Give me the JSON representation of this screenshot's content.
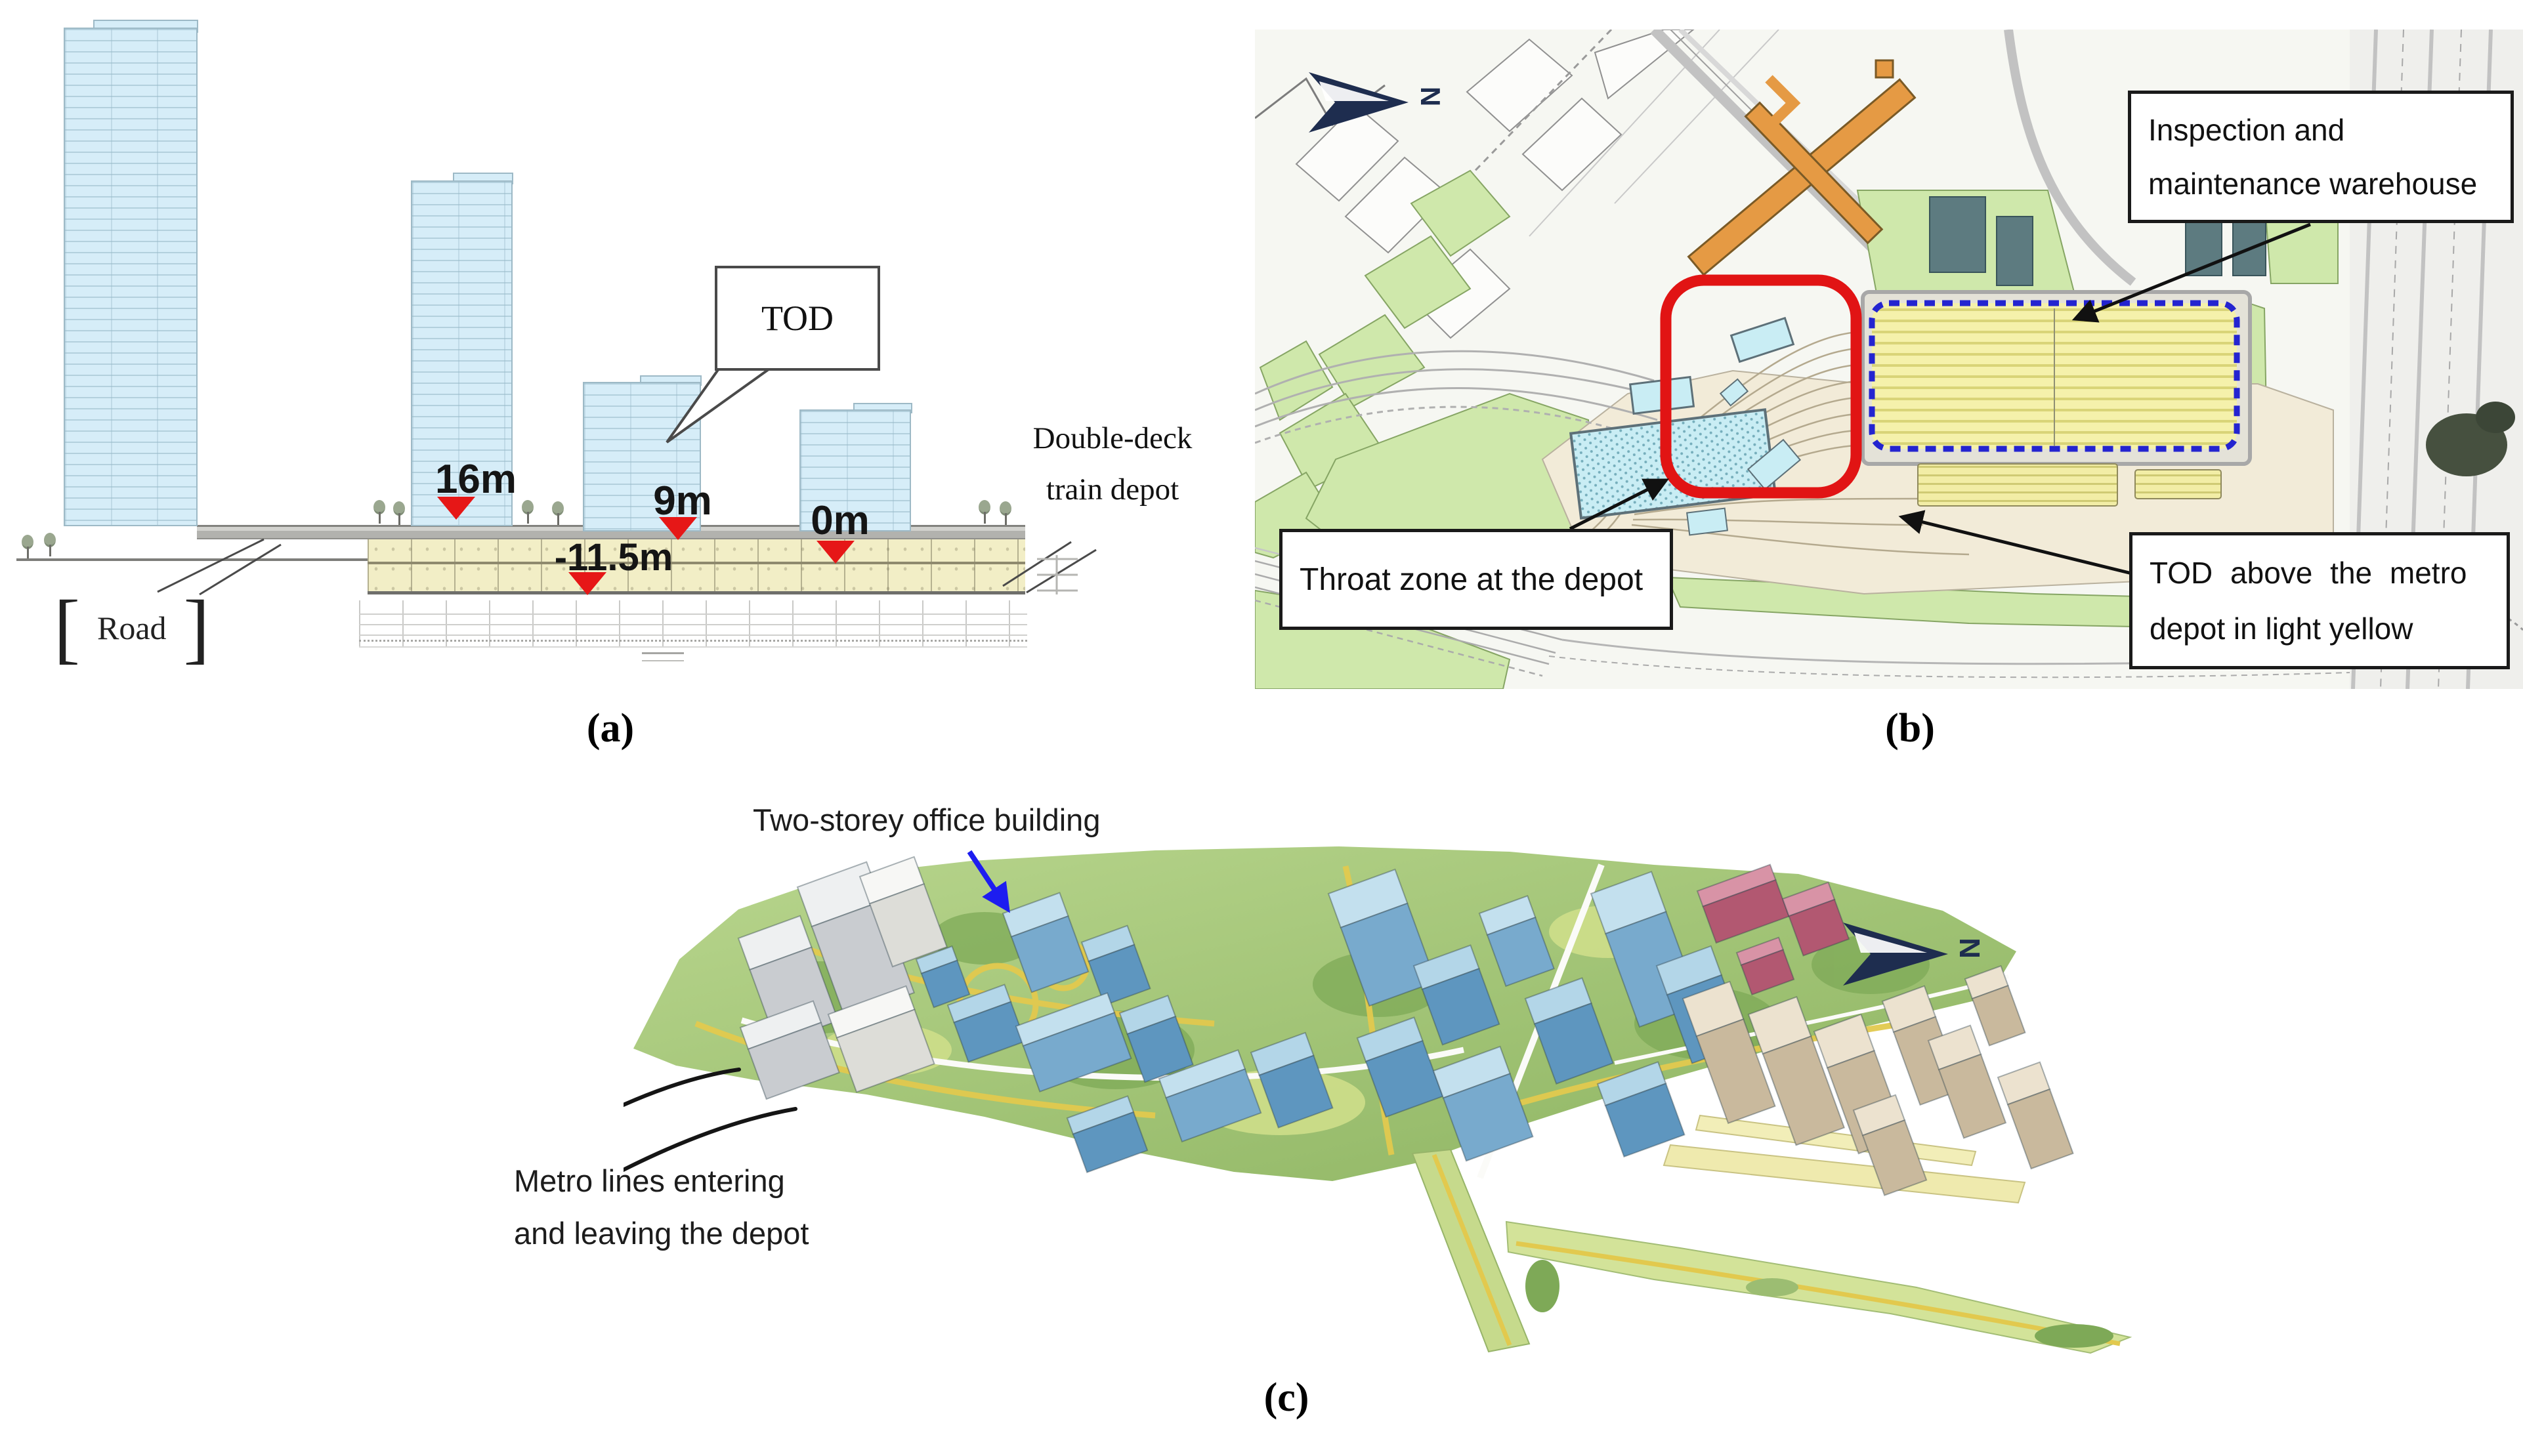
{
  "figure": {
    "panel_a": {
      "caption": "(a)",
      "tod_callout": "TOD",
      "road_label": "Road",
      "depot_label_line1": "Double-deck",
      "depot_label_line2": "train depot",
      "markers": {
        "m16": "16m",
        "m9": "9m",
        "m0": "0m",
        "m115": "-11.5m"
      }
    },
    "panel_b": {
      "caption": "(b)",
      "north_label": "N",
      "warehouse_label_line1": "Inspection and",
      "warehouse_label_line2": "maintenance warehouse",
      "throat_label": "Throat zone at the depot",
      "tod_label_line1": "TOD above the metro",
      "tod_label_line2": "depot in light yellow"
    },
    "panel_c": {
      "caption": "(c)",
      "north_label": "N",
      "office_label": "Two-storey office building",
      "metro_label_line1": "Metro lines entering",
      "metro_label_line2": "and leaving the depot"
    },
    "colors": {
      "tower_fill": "#d6edf8",
      "depot_fill": "#f2eec6",
      "deck_gray": "#b2b2ae",
      "marker_red": "#e61717",
      "throat_outline_red": "#e11414",
      "warehouse_border_blue": "#2424d0",
      "warehouse_fill": "#f5f1ab",
      "map_green": "#cfe8ab",
      "station_orange": "#e59a44",
      "cyan_building": "#c9edf4",
      "north_navy": "#1e2d4f",
      "render_blue": "#5e96bf",
      "render_beige": "#c9b99d",
      "render_pink": "#b25871",
      "arrow_blue": "#1d1df0"
    }
  }
}
